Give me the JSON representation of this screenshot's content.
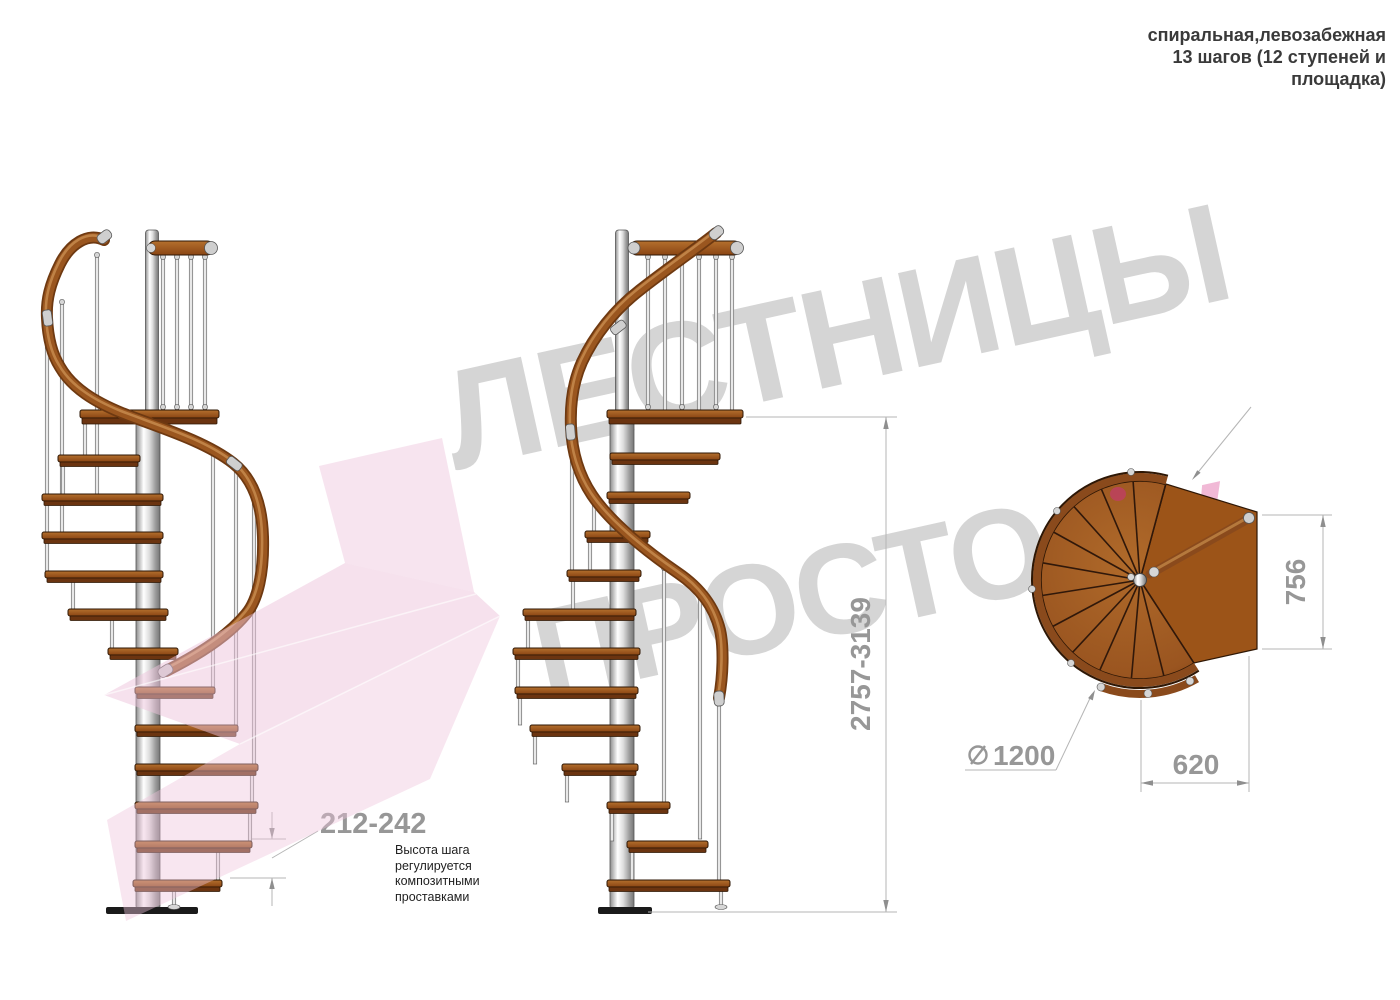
{
  "header": {
    "line1": "спиральная,левозабежная",
    "line2": "13 шагов (12 ступеней и",
    "line3": "площадка)"
  },
  "watermark": {
    "word1": "ЛЕСТНИЦЫ",
    "word2": "ПРОСТО",
    "word2_suffix": ".Ру"
  },
  "dimensions": {
    "step_height_range": "212-242",
    "total_height_range": "2757-3139",
    "landing_depth": "756",
    "landing_width": "620",
    "diameter_symbol": "⌀",
    "diameter": "1200"
  },
  "note": {
    "step_height_text": "Высота шага\nрегулируется\nкомпозитными\nпроставками"
  },
  "colors": {
    "wood": "#a3561c",
    "wood_dark": "#6b3410",
    "handrail": "#9a561f",
    "steel": "#e8e8e8",
    "dim_text": "#979797",
    "dim_line": "#b5b5b5",
    "note_text": "#1f1f1f",
    "header_text": "#3a3a3a",
    "watermark_gray": "#d5d5d5",
    "watermark_pink": "#f1b9d6",
    "arrow_pink": "#eec3dc",
    "plan_dot_red": "#bf3f63"
  }
}
